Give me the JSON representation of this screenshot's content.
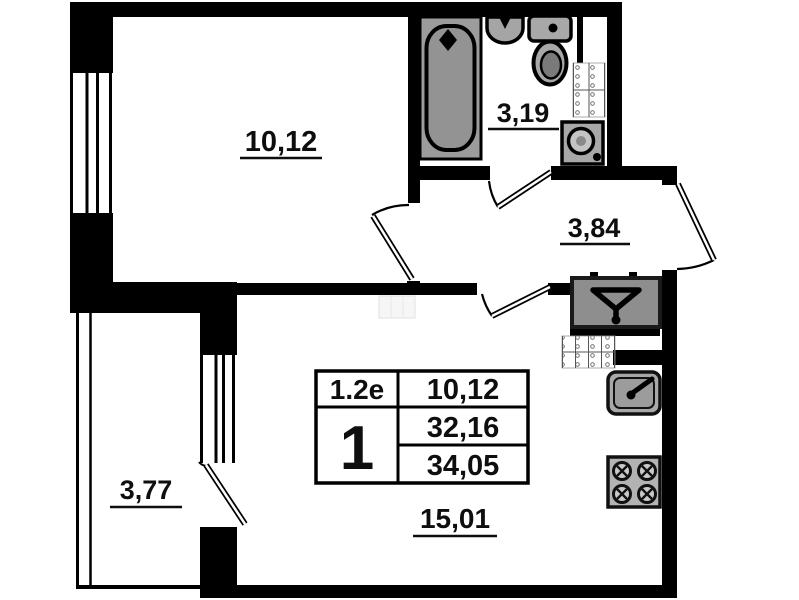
{
  "unit_card": {
    "type_code": "1.2e",
    "rooms_count": "1",
    "living_area": "10,12",
    "apartment_area": "32,16",
    "total_area": "34,05"
  },
  "rooms": {
    "bedroom": "10,12",
    "bathroom": "3,19",
    "hallway": "3,84",
    "balcony": "3,77",
    "kitchen_living": "15,01"
  },
  "colors": {
    "wall": "#000000",
    "fixture_fill": "#a5a5a5",
    "vent_box_fill": "#8e8e8e",
    "background": "#ffffff"
  }
}
